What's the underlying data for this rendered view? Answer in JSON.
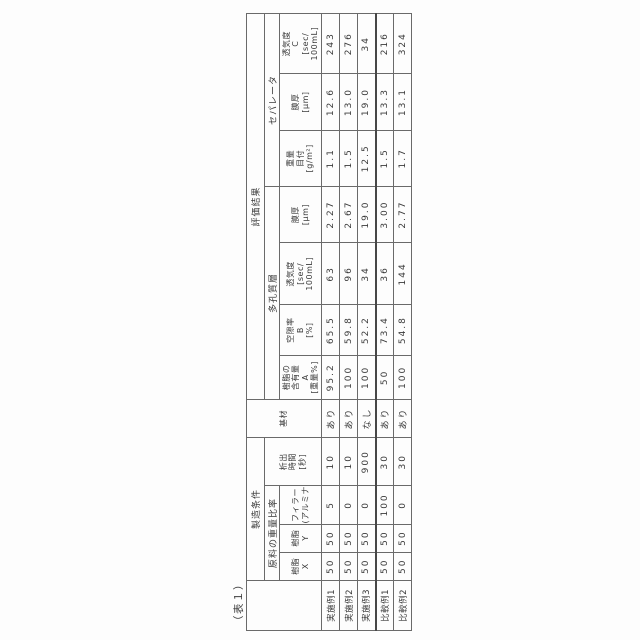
{
  "page": {
    "caption": "（表１）",
    "colors": {
      "text": "#3a3a3a",
      "border": "#6a6a6a",
      "border_strong": "#474747",
      "background": "#ffffff"
    }
  },
  "table": {
    "col_widths": [
      50,
      28,
      28,
      38,
      48,
      38,
      44,
      50,
      62,
      56,
      56,
      56,
      60
    ],
    "groups": {
      "manufacturing_conditions": "製造条件",
      "raw_material_weight_ratio": "原料の重量比率",
      "evaluation_results": "評価結果",
      "porous_layer": "多孔質層",
      "separator": "セパレータ"
    },
    "columns": [
      {
        "id": "resin-x",
        "header_lines": [
          "樹脂",
          "X"
        ]
      },
      {
        "id": "resin-y",
        "header_lines": [
          "樹脂",
          "Y"
        ]
      },
      {
        "id": "filler-alumina",
        "header_lines": [
          "フィラー",
          "(アルミナ)"
        ]
      },
      {
        "id": "deposition-time",
        "header_lines": [
          "析出",
          "時間",
          "[秒]"
        ]
      },
      {
        "id": "substrate",
        "header_lines": [
          "基材"
        ]
      },
      {
        "id": "resin-content-a",
        "header_lines": [
          "樹脂の",
          "含有量",
          "A",
          "[重量%]"
        ]
      },
      {
        "id": "porosity-b",
        "header_lines": [
          "空隙率",
          "B",
          "[%]"
        ]
      },
      {
        "id": "air-permeability-porous",
        "header_lines": [
          "透気度",
          "[sec/",
          "100mL]"
        ]
      },
      {
        "id": "film-thickness-porous",
        "header_lines": [
          "膜厚",
          "[μm]"
        ]
      },
      {
        "id": "basis-weight",
        "header_lines": [
          "重量",
          "目付",
          "[g/m²]"
        ]
      },
      {
        "id": "film-thickness-separator",
        "header_lines": [
          "膜厚",
          "[μm]"
        ]
      },
      {
        "id": "air-permeability-c",
        "header_lines": [
          "透気度",
          "C",
          "[sec/",
          "100mL]"
        ]
      }
    ],
    "rows": [
      {
        "label": "実施例1",
        "values": [
          "50",
          "50",
          "5",
          "10",
          "あり",
          "95.2",
          "65.5",
          "63",
          "2.27",
          "1.1",
          "12.6",
          "243"
        ]
      },
      {
        "label": "実施例2",
        "values": [
          "50",
          "50",
          "0",
          "10",
          "あり",
          "100",
          "59.8",
          "96",
          "2.67",
          "1.5",
          "13.0",
          "276"
        ]
      },
      {
        "label": "実施例3",
        "values": [
          "50",
          "50",
          "0",
          "900",
          "なし",
          "100",
          "52.2",
          "34",
          "19.0",
          "12.5",
          "19.0",
          "34"
        ]
      },
      {
        "label": "比較例1",
        "values": [
          "50",
          "50",
          "100",
          "30",
          "あり",
          "50",
          "73.4",
          "36",
          "3.00",
          "1.5",
          "13.3",
          "216"
        ],
        "thick_top": true
      },
      {
        "label": "比較例2",
        "values": [
          "50",
          "50",
          "0",
          "30",
          "あり",
          "100",
          "54.8",
          "144",
          "2.77",
          "1.7",
          "13.1",
          "324"
        ]
      }
    ]
  }
}
